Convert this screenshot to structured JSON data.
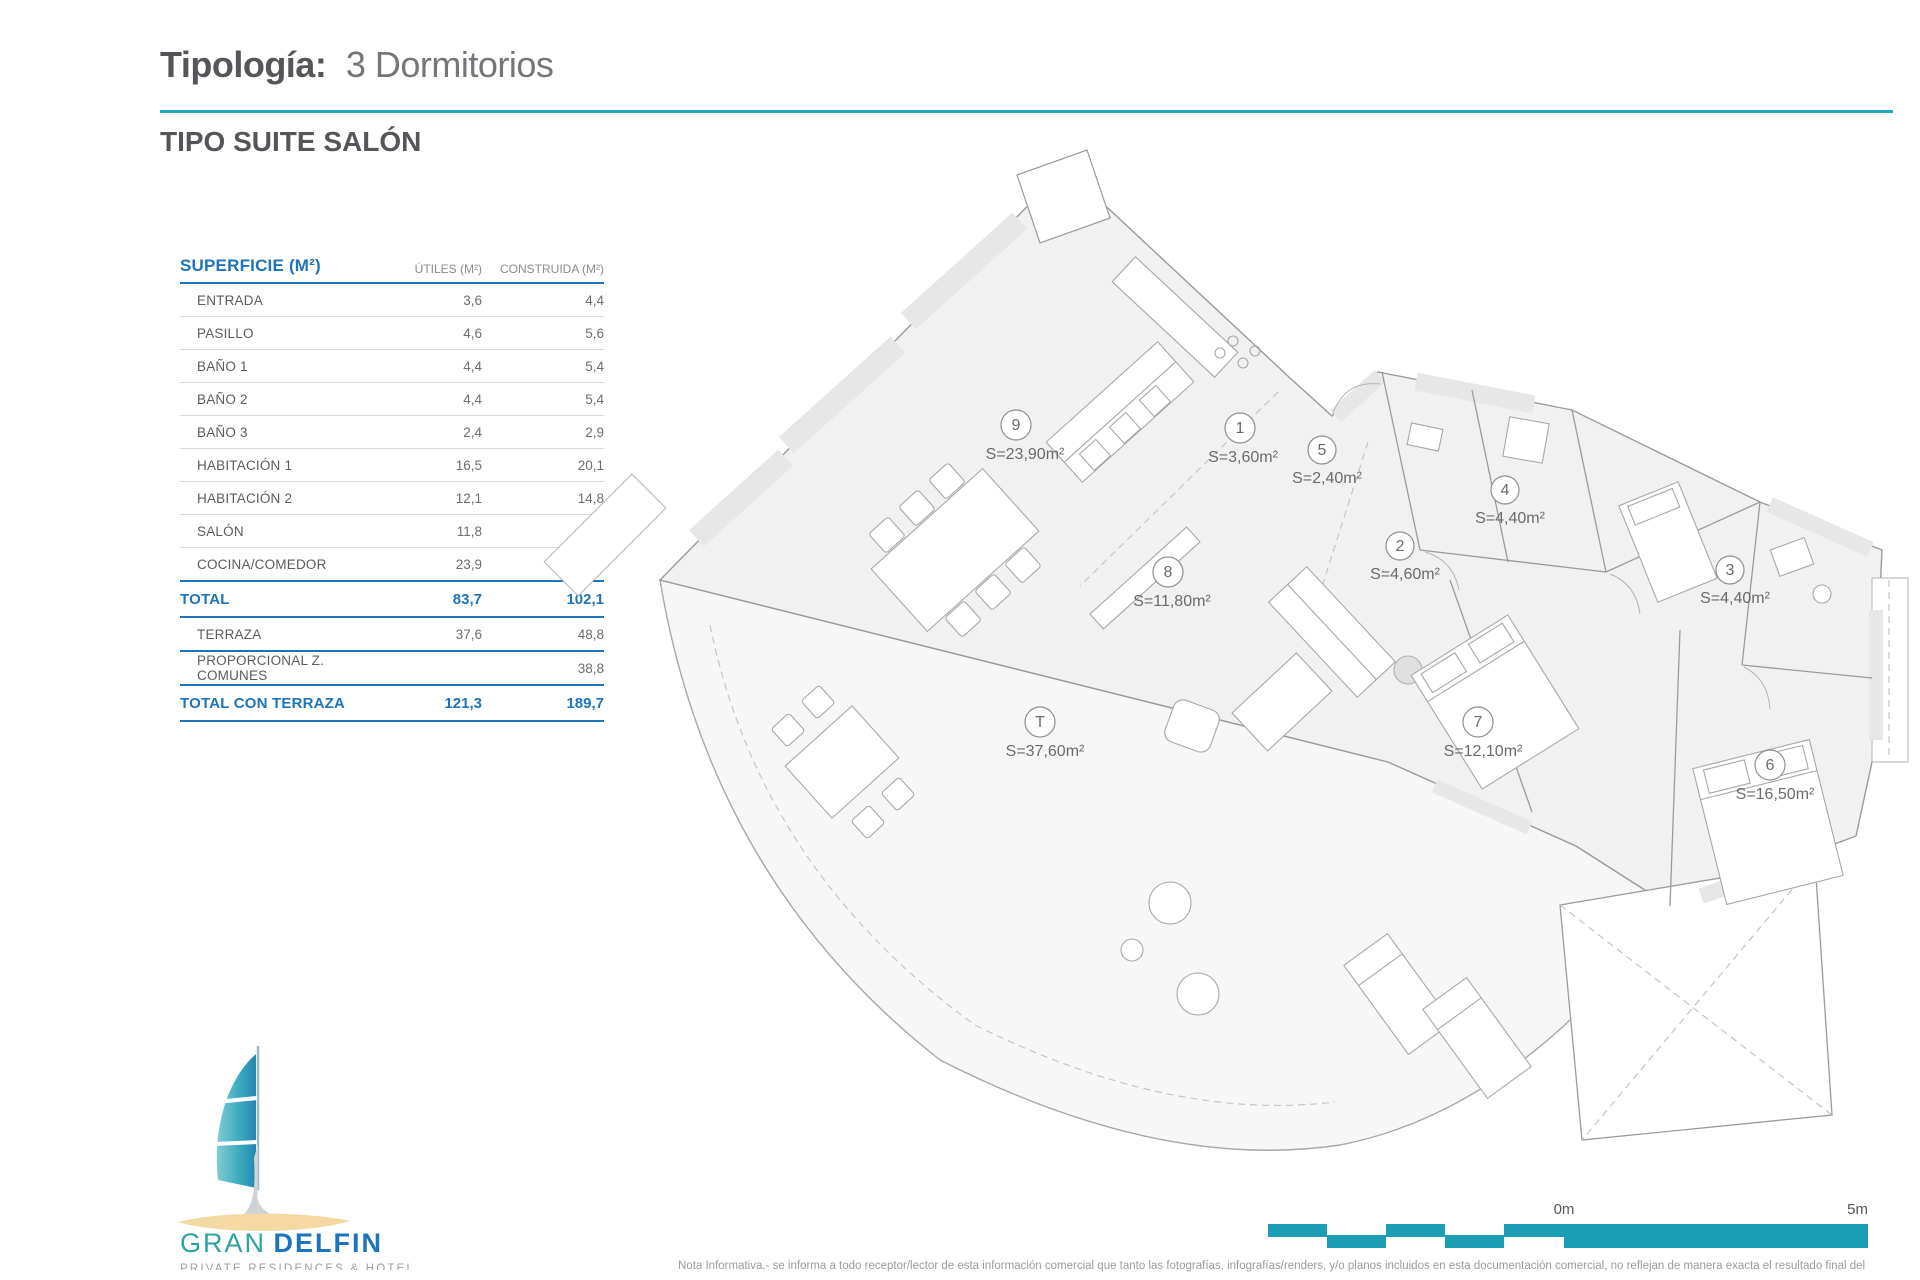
{
  "header": {
    "title_label": "Tipología:",
    "title_value": "3 Dormitorios",
    "subtitle": "TIPO SUITE SALÓN"
  },
  "table": {
    "title": "SUPERFICIE (M²)",
    "col_utiles": "ÚTILES (M²)",
    "col_construida": "CONSTRUIDA (M²)",
    "rows": [
      {
        "label": "ENTRADA",
        "utiles": "3,6",
        "construida": "4,4"
      },
      {
        "label": "PASILLO",
        "utiles": "4,6",
        "construida": "5,6"
      },
      {
        "label": "BAÑO 1",
        "utiles": "4,4",
        "construida": "5,4"
      },
      {
        "label": "BAÑO 2",
        "utiles": "4,4",
        "construida": "5,4"
      },
      {
        "label": "BAÑO 3",
        "utiles": "2,4",
        "construida": "2,9"
      },
      {
        "label": "HABITACIÓN 1",
        "utiles": "16,5",
        "construida": "20,1"
      },
      {
        "label": "HABITACIÓN 2",
        "utiles": "12,1",
        "construida": "14,8"
      },
      {
        "label": "SALÓN",
        "utiles": "11,8",
        "construida": "14,4"
      },
      {
        "label": "COCINA/COMEDOR",
        "utiles": "23,9",
        "construida": "29,2"
      }
    ],
    "total": {
      "label": "TOTAL",
      "utiles": "83,7",
      "construida": "102,1"
    },
    "terraza": {
      "label": "TERRAZA",
      "utiles": "37,6",
      "construida": "48,8"
    },
    "comunes": {
      "label": "PROPORCIONAL Z. COMUNES",
      "utiles": "",
      "construida": "38,8"
    },
    "total_terraza": {
      "label": "TOTAL CON TERRAZA",
      "utiles": "121,3",
      "construida": "189,7"
    }
  },
  "plan": {
    "rooms": [
      {
        "num": "9",
        "area": "S=23,90m²"
      },
      {
        "num": "1",
        "area": "S=3,60m²"
      },
      {
        "num": "5",
        "area": "S=2,40m²"
      },
      {
        "num": "4",
        "area": "S=4,40m²"
      },
      {
        "num": "2",
        "area": "S=4,60m²"
      },
      {
        "num": "3",
        "area": "S=4,40m²"
      },
      {
        "num": "8",
        "area": "S=11,80m²"
      },
      {
        "num": "T",
        "area": "S=37,60m²"
      },
      {
        "num": "7",
        "area": "S=12,10m²"
      },
      {
        "num": "6",
        "area": "S=16,50m²"
      }
    ]
  },
  "logo": {
    "gran": "GRAN",
    "delfin": "DELFIN",
    "tagline": "PRIVATE RESIDENCES & HOTEL"
  },
  "scale": {
    "start": "0m",
    "end": "5m"
  },
  "footer": {
    "disclaimer": "Nota Informativa.- se informa a todo receptor/lector de esta información comercial que tanto las fotografías, infografías/renders, y/o planos incluidos en esta documentación comercial, no reflejan de manera exacta el resultado final del"
  },
  "colors": {
    "accent_teal": "#21a9c2",
    "scale_teal": "#1b9db6",
    "brand_blue": "#1c75bc",
    "logo_teal": "#2ba39e",
    "sand": "#f4d9a2"
  }
}
